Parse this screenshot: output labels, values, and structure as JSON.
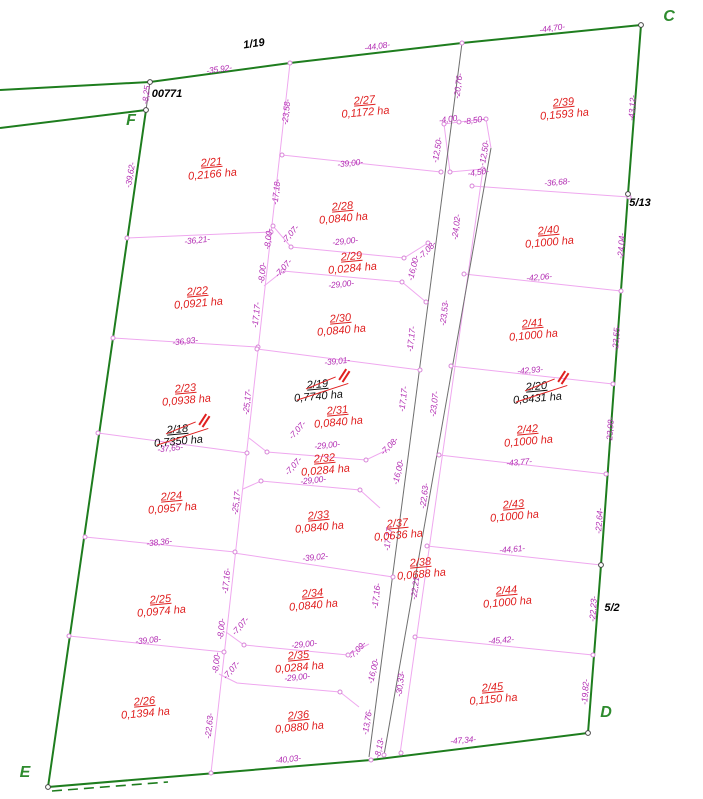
{
  "title": "Cadastral parcel subdivision plan",
  "map": {
    "colors": {
      "boundary_green": "#1e7d1e",
      "parcel_line_pink": "#efa8ef",
      "road_line_gray": "#6f6f6f",
      "dimension_magenta": "#b32eb3",
      "parcel_red": "#e02020",
      "cancelled_black": "#111111",
      "strike_red": "#e02020"
    },
    "corner_labels": [
      {
        "t": "C",
        "x": 669,
        "y": 17
      },
      {
        "t": "D",
        "x": 606,
        "y": 713
      },
      {
        "t": "E",
        "x": 25,
        "y": 773
      },
      {
        "t": "F",
        "x": 131,
        "y": 121
      }
    ],
    "neighbor_labels": [
      {
        "t": "1/19",
        "x": 254,
        "y": 44,
        "r": -8
      },
      {
        "t": "00771",
        "x": 167,
        "y": 94,
        "r": 0
      },
      {
        "t": "5/13",
        "x": 640,
        "y": 203,
        "r": 0
      },
      {
        "t": "5/2",
        "x": 612,
        "y": 608,
        "r": 0
      }
    ],
    "parcels": [
      {
        "num": "2/21",
        "area": "0,2166 ha",
        "x": 212,
        "y": 169
      },
      {
        "num": "2/22",
        "area": "0,0921 ha",
        "x": 198,
        "y": 298
      },
      {
        "num": "2/23",
        "area": "0,0938 ha",
        "x": 186,
        "y": 395
      },
      {
        "num": "2/24",
        "area": "0,0957 ha",
        "x": 172,
        "y": 503
      },
      {
        "num": "2/25",
        "area": "0,0974 ha",
        "x": 161,
        "y": 606
      },
      {
        "num": "2/26",
        "area": "0,1394 ha",
        "x": 145,
        "y": 708
      },
      {
        "num": "2/27",
        "area": "0,1172 ha",
        "x": 365,
        "y": 107
      },
      {
        "num": "2/28",
        "area": "0,0840 ha",
        "x": 343,
        "y": 213
      },
      {
        "num": "2/29",
        "area": "0,0284 ha",
        "x": 352,
        "y": 263
      },
      {
        "num": "2/30",
        "area": "0,0840 ha",
        "x": 341,
        "y": 325
      },
      {
        "num": "2/31",
        "area": "0,0840 ha",
        "x": 338,
        "y": 417
      },
      {
        "num": "2/32",
        "area": "0,0284 ha",
        "x": 325,
        "y": 465
      },
      {
        "num": "2/33",
        "area": "0,0840 ha",
        "x": 319,
        "y": 522
      },
      {
        "num": "2/34",
        "area": "0,0840 ha",
        "x": 313,
        "y": 600
      },
      {
        "num": "2/35",
        "area": "0,0284 ha",
        "x": 299,
        "y": 662
      },
      {
        "num": "2/36",
        "area": "0,0880 ha",
        "x": 299,
        "y": 722
      },
      {
        "num": "2/37",
        "area": "0,0636 ha",
        "x": 398,
        "y": 530
      },
      {
        "num": "2/38",
        "area": "0,0688 ha",
        "x": 421,
        "y": 569
      },
      {
        "num": "2/39",
        "area": "0,1593 ha",
        "x": 564,
        "y": 109
      },
      {
        "num": "2/40",
        "area": "0,1000 ha",
        "x": 549,
        "y": 237
      },
      {
        "num": "2/41",
        "area": "0,1000 ha",
        "x": 533,
        "y": 330
      },
      {
        "num": "2/42",
        "area": "0,1000 ha",
        "x": 528,
        "y": 436
      },
      {
        "num": "2/43",
        "area": "0,1000 ha",
        "x": 514,
        "y": 511
      },
      {
        "num": "2/44",
        "area": "0,1000 ha",
        "x": 507,
        "y": 597
      },
      {
        "num": "2/45",
        "area": "0,1150 ha",
        "x": 493,
        "y": 694
      }
    ],
    "cancelled_parcels": [
      {
        "num": "2/18",
        "area": "0,7350 ha",
        "x": 178,
        "y": 436
      },
      {
        "num": "2/19",
        "area": "0,7740 ha",
        "x": 318,
        "y": 391
      },
      {
        "num": "2/20",
        "area": "0,8431 ha",
        "x": 537,
        "y": 393
      }
    ],
    "dimensions": [
      {
        "t": "-35,92-",
        "x": 219,
        "y": 69,
        "r": -8
      },
      {
        "t": "-44,08-",
        "x": 377,
        "y": 46,
        "r": -8
      },
      {
        "t": "-44,70-",
        "x": 552,
        "y": 28,
        "r": -8
      },
      {
        "t": "-8,25",
        "x": 146,
        "y": 95,
        "r": -84
      },
      {
        "t": "-39,62-",
        "x": 130,
        "y": 175,
        "r": -80
      },
      {
        "t": "-43,12-",
        "x": 632,
        "y": 108,
        "r": -86
      },
      {
        "t": "-24,04-",
        "x": 621,
        "y": 246,
        "r": -86
      },
      {
        "t": "-23,55-",
        "x": 616,
        "y": 338,
        "r": -86
      },
      {
        "t": "-23,08-",
        "x": 610,
        "y": 430,
        "r": -86
      },
      {
        "t": "-22,64-",
        "x": 599,
        "y": 521,
        "r": -86
      },
      {
        "t": "-22,23-",
        "x": 593,
        "y": 609,
        "r": -86
      },
      {
        "t": "-19,82-",
        "x": 585,
        "y": 692,
        "r": -86
      },
      {
        "t": "-47,34-",
        "x": 463,
        "y": 740,
        "r": -5
      },
      {
        "t": "-23,58-",
        "x": 286,
        "y": 112,
        "r": -84
      },
      {
        "t": "-17,18-",
        "x": 276,
        "y": 192,
        "r": -84
      },
      {
        "t": "-8,00-",
        "x": 268,
        "y": 239,
        "r": -84
      },
      {
        "t": "-7,07-",
        "x": 290,
        "y": 234,
        "r": -48
      },
      {
        "t": "-8,00-",
        "x": 262,
        "y": 273,
        "r": -84
      },
      {
        "t": "-7,07-",
        "x": 283,
        "y": 268,
        "r": -48
      },
      {
        "t": "-17,17-",
        "x": 256,
        "y": 315,
        "r": -84
      },
      {
        "t": "-25,17-",
        "x": 247,
        "y": 402,
        "r": -84
      },
      {
        "t": "-7,07-",
        "x": 297,
        "y": 430,
        "r": -48
      },
      {
        "t": "-7,07-",
        "x": 293,
        "y": 466,
        "r": -48
      },
      {
        "t": "-25,17-",
        "x": 236,
        "y": 502,
        "r": -84
      },
      {
        "t": "-17,16-",
        "x": 226,
        "y": 581,
        "r": -84
      },
      {
        "t": "-8,00-",
        "x": 221,
        "y": 629,
        "r": -84
      },
      {
        "t": "-7,07-",
        "x": 240,
        "y": 626,
        "r": -48
      },
      {
        "t": "-8,00-",
        "x": 216,
        "y": 663,
        "r": -84
      },
      {
        "t": "-7,07-",
        "x": 231,
        "y": 670,
        "r": -48
      },
      {
        "t": "-22,63-",
        "x": 209,
        "y": 726,
        "r": -84
      },
      {
        "t": "-36,21-",
        "x": 197,
        "y": 240,
        "r": -6
      },
      {
        "t": "-36,93-",
        "x": 185,
        "y": 341,
        "r": -6
      },
      {
        "t": "-37,65-",
        "x": 170,
        "y": 448,
        "r": -6
      },
      {
        "t": "-38,36-",
        "x": 159,
        "y": 542,
        "r": -6
      },
      {
        "t": "-39,08-",
        "x": 148,
        "y": 640,
        "r": -6
      },
      {
        "t": "-40,03-",
        "x": 288,
        "y": 759,
        "r": -6
      },
      {
        "t": "-39,00-",
        "x": 350,
        "y": 163,
        "r": -6
      },
      {
        "t": "-29,00-",
        "x": 345,
        "y": 241,
        "r": -6
      },
      {
        "t": "-29,00-",
        "x": 341,
        "y": 284,
        "r": -6
      },
      {
        "t": "-39,01-",
        "x": 337,
        "y": 361,
        "r": -6
      },
      {
        "t": "-29,00-",
        "x": 327,
        "y": 445,
        "r": -6
      },
      {
        "t": "-29,00-",
        "x": 313,
        "y": 480,
        "r": -6
      },
      {
        "t": "-39,02-",
        "x": 315,
        "y": 557,
        "r": -6
      },
      {
        "t": "-29,00-",
        "x": 304,
        "y": 644,
        "r": -6
      },
      {
        "t": "-29,00-",
        "x": 297,
        "y": 677,
        "r": -6
      },
      {
        "t": "-7,08-",
        "x": 427,
        "y": 250,
        "r": -45
      },
      {
        "t": "-16,00-",
        "x": 413,
        "y": 268,
        "r": -76
      },
      {
        "t": "-7,08-",
        "x": 389,
        "y": 446,
        "r": -45
      },
      {
        "t": "-16,00-",
        "x": 398,
        "y": 472,
        "r": -76
      },
      {
        "t": "-7,09-",
        "x": 357,
        "y": 650,
        "r": -45
      },
      {
        "t": "-16,00-",
        "x": 373,
        "y": 671,
        "r": -76
      },
      {
        "t": "-20,76-",
        "x": 458,
        "y": 86,
        "r": -83
      },
      {
        "t": "-4,00",
        "x": 448,
        "y": 119,
        "r": -8
      },
      {
        "t": "-8,50-",
        "x": 474,
        "y": 120,
        "r": -8
      },
      {
        "t": "-12,50-",
        "x": 437,
        "y": 150,
        "r": -80
      },
      {
        "t": "-12,50-",
        "x": 484,
        "y": 153,
        "r": -80
      },
      {
        "t": "-4,50-",
        "x": 478,
        "y": 172,
        "r": -8
      },
      {
        "t": "-24,02-",
        "x": 456,
        "y": 227,
        "r": -83
      },
      {
        "t": "-23,53-",
        "x": 444,
        "y": 313,
        "r": -83
      },
      {
        "t": "-17,17-",
        "x": 411,
        "y": 339,
        "r": -83
      },
      {
        "t": "-17,17-",
        "x": 403,
        "y": 399,
        "r": -83
      },
      {
        "t": "-23,07-",
        "x": 434,
        "y": 404,
        "r": -83
      },
      {
        "t": "-22,63-",
        "x": 424,
        "y": 496,
        "r": -83
      },
      {
        "t": "-17,17-",
        "x": 388,
        "y": 538,
        "r": -83
      },
      {
        "t": "-17,16-",
        "x": 376,
        "y": 596,
        "r": -83
      },
      {
        "t": "-22,21-",
        "x": 415,
        "y": 587,
        "r": -83
      },
      {
        "t": "-30,33-",
        "x": 400,
        "y": 684,
        "r": -83
      },
      {
        "t": "-13,76-",
        "x": 367,
        "y": 722,
        "r": -80
      },
      {
        "t": "-8,13-",
        "x": 379,
        "y": 748,
        "r": -78
      },
      {
        "t": "-36,68-",
        "x": 557,
        "y": 182,
        "r": -5
      },
      {
        "t": "-42,06-",
        "x": 539,
        "y": 277,
        "r": -5
      },
      {
        "t": "-42,93-",
        "x": 530,
        "y": 370,
        "r": -5
      },
      {
        "t": "-43,77-",
        "x": 519,
        "y": 462,
        "r": -5
      },
      {
        "t": "-44,61-",
        "x": 512,
        "y": 549,
        "r": -5
      },
      {
        "t": "-45,42-",
        "x": 501,
        "y": 640,
        "r": -5
      }
    ]
  }
}
